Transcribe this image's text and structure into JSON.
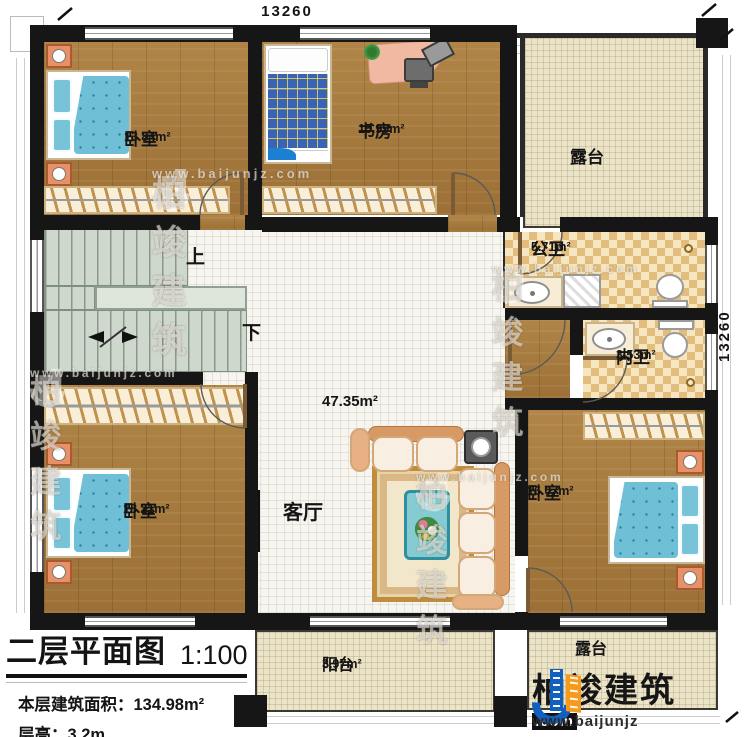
{
  "title_block": {
    "title": "二层平面图",
    "scale": "1:100",
    "floor_area_line": "本层建筑面积：134.98m²",
    "floor_height_line": "层高：3.2m"
  },
  "dimensions": {
    "top": "13260",
    "right": "13260"
  },
  "rooms": {
    "bedroom_tl": {
      "label": "卧室",
      "area": "13.84m²"
    },
    "study": {
      "label": "书房",
      "area": "15.99m²"
    },
    "terrace_top": {
      "label": "露台"
    },
    "public_bath": {
      "label": "公卫",
      "area": "5.71m²"
    },
    "inner_bath": {
      "label": "内卫",
      "area": "3.53m²"
    },
    "living": {
      "label": "客厅",
      "area": "47.35m²"
    },
    "bedroom_bl": {
      "label": "卧室",
      "area": "18.21m²"
    },
    "bedroom_br": {
      "label": "卧室",
      "area": "16.07m²"
    },
    "balcony": {
      "label": "阳台",
      "area": "3.97m²"
    },
    "terrace_bottom": {
      "label": "露台"
    }
  },
  "stairs": {
    "up": "上",
    "down": "下"
  },
  "brand": {
    "name": "柏竣建筑",
    "url_prefix": "www.baijunjz",
    "url_suffix": ".com"
  },
  "watermark": {
    "name": "柏竣建筑",
    "url": "www.baijunjz.com"
  },
  "colors": {
    "wall": "#161616",
    "wood_floor": "#a5793d",
    "bath_tile": "#e3bd7e",
    "terrace": "#ece4c8",
    "stairs": "#cfd8cd",
    "bed_blue": "#6fc0d6",
    "sofa_tan": "#e7b183",
    "brand_blue": "#1160bf",
    "brand_orange": "#f59a1d"
  }
}
